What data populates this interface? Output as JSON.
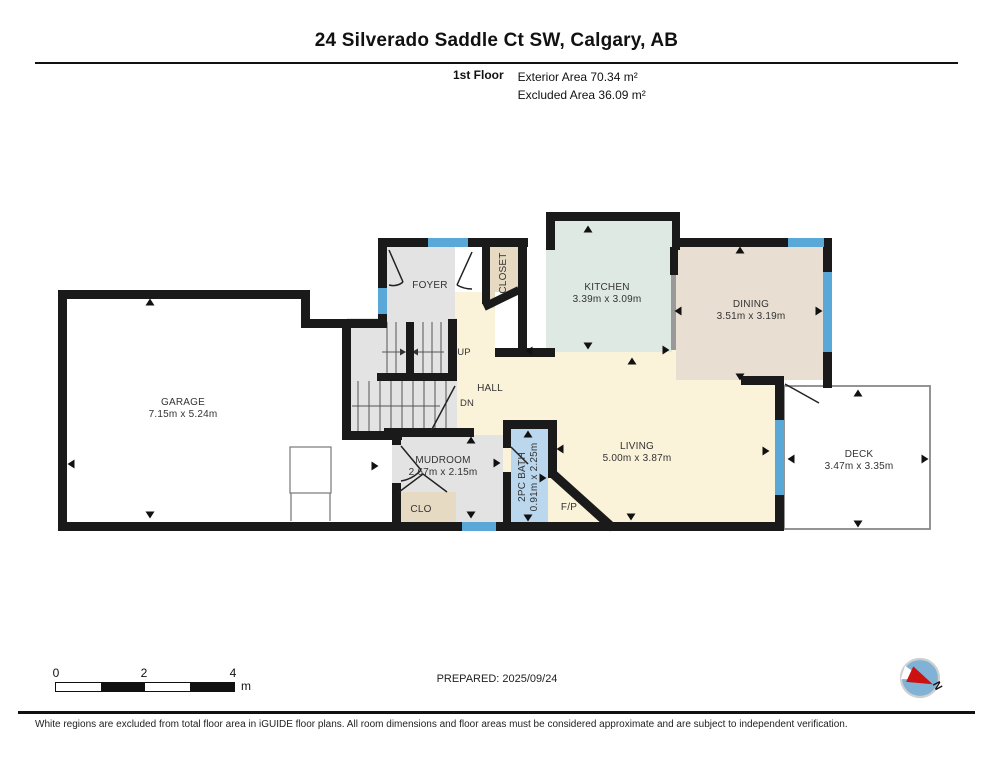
{
  "header": {
    "title": "24 Silverado Saddle Ct SW, Calgary, AB",
    "floor_label": "1st Floor",
    "area_line1": "Exterior Area 70.34 m²",
    "area_line2": "Excluded Area 36.09 m²"
  },
  "rooms": {
    "garage": {
      "name": "GARAGE",
      "dims": "7.15m x 5.24m"
    },
    "foyer": {
      "name": "FOYER"
    },
    "closet": {
      "name": "CLOSET"
    },
    "kitchen": {
      "name": "KITCHEN",
      "dims": "3.39m x 3.09m"
    },
    "dining": {
      "name": "DINING",
      "dims": "3.51m x 3.19m"
    },
    "hall": {
      "name": "HALL"
    },
    "stairs_up": {
      "name": "UP"
    },
    "stairs_down": {
      "name": "DN"
    },
    "mudroom": {
      "name": "MUDROOM",
      "dims": "2.67m x 2.15m"
    },
    "clo": {
      "name": "CLO"
    },
    "bath": {
      "name": "2PC BATH",
      "dims": "0.91m x 2.25m"
    },
    "living": {
      "name": "LIVING",
      "dims": "5.00m x 3.87m"
    },
    "fireplace": {
      "name": "F/P"
    },
    "deck": {
      "name": "DECK",
      "dims": "3.47m x 3.35m"
    }
  },
  "scale_bar": {
    "tick0": "0",
    "tick2": "2",
    "tick4": "4",
    "unit": "m"
  },
  "prepared_label": "PREPARED: 2025/09/24",
  "compass": {
    "north_label": "N"
  },
  "footer_note": "White regions are excluded from total floor area in iGUIDE floor plans. All room dimensions and floor areas must be considered approximate and are subject to independent verification.",
  "colors": {
    "wall": "#1a1a1a",
    "window": "#5aa8d8",
    "room_gray": "#e3e3e3",
    "room_tan": "#e7dac3",
    "room_sage": "#dfe9e3",
    "room_beige": "#e8dfd2",
    "room_cream": "#faf3da",
    "room_bath_blue": "#bad7ee",
    "compass_blue": "#7fb2d4",
    "compass_red": "#cc1111"
  }
}
